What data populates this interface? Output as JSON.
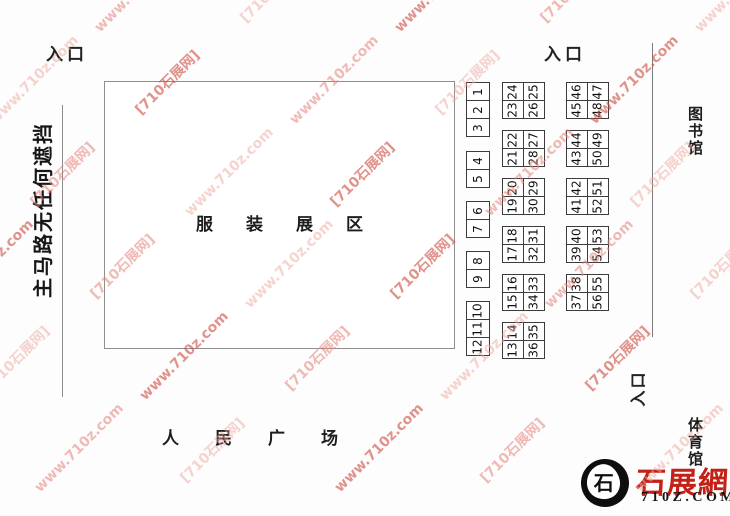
{
  "canvas": {
    "bg": "#fdfdfd"
  },
  "labels": {
    "entrance_top_left": "入口",
    "entrance_top_right": "入口",
    "entrance_bottom_right": "入口",
    "road_left": "主马路无任何遮挡",
    "exhibit_area": "服装展区",
    "plaza": "人民广场",
    "library": "图书馆",
    "gymnasium": "体育馆"
  },
  "booths": {
    "strip1": {
      "groups": [
        [
          "1",
          "2",
          "3"
        ],
        [
          "4",
          "5"
        ],
        [
          "6",
          "7"
        ],
        [
          "8",
          "9"
        ],
        [
          "10",
          "11",
          "12"
        ]
      ]
    },
    "strip2": {
      "groups": [
        {
          "left": [
            "24",
            "23"
          ],
          "right": [
            "25",
            "26"
          ]
        },
        {
          "left": [
            "22",
            "21"
          ],
          "right": [
            "27",
            "28"
          ]
        },
        {
          "left": [
            "20",
            "19"
          ],
          "right": [
            "29",
            "30"
          ]
        },
        {
          "left": [
            "18",
            "17"
          ],
          "right": [
            "31",
            "32"
          ]
        },
        {
          "left": [
            "16",
            "15"
          ],
          "right": [
            "33",
            "34"
          ]
        },
        {
          "left": [
            "14",
            "13"
          ],
          "right": [
            "35",
            "36"
          ]
        }
      ]
    },
    "strip3": {
      "groups": [
        {
          "left": [
            "46",
            "45"
          ],
          "right": [
            "47",
            "48"
          ]
        },
        {
          "left": [
            "44",
            "43"
          ],
          "right": [
            "49",
            "50"
          ]
        },
        {
          "left": [
            "42",
            "41"
          ],
          "right": [
            "51",
            "52"
          ]
        },
        {
          "left": [
            "40",
            "39"
          ],
          "right": [
            "53",
            "54"
          ]
        },
        {
          "left": [
            "38",
            "37"
          ],
          "right": [
            "55",
            "56"
          ]
        }
      ]
    }
  },
  "watermark": {
    "text_a": "[710石展网]",
    "text_b": "www.710z.com",
    "colors": [
      "rgba(205,75,62,0.60)",
      "rgba(228,130,120,0.55)",
      "rgba(238,168,158,0.50)"
    ]
  },
  "logo": {
    "seal_char": "石",
    "brand": "石展網",
    "domain": "710Z.COM",
    "brand_color": "#c32017"
  }
}
